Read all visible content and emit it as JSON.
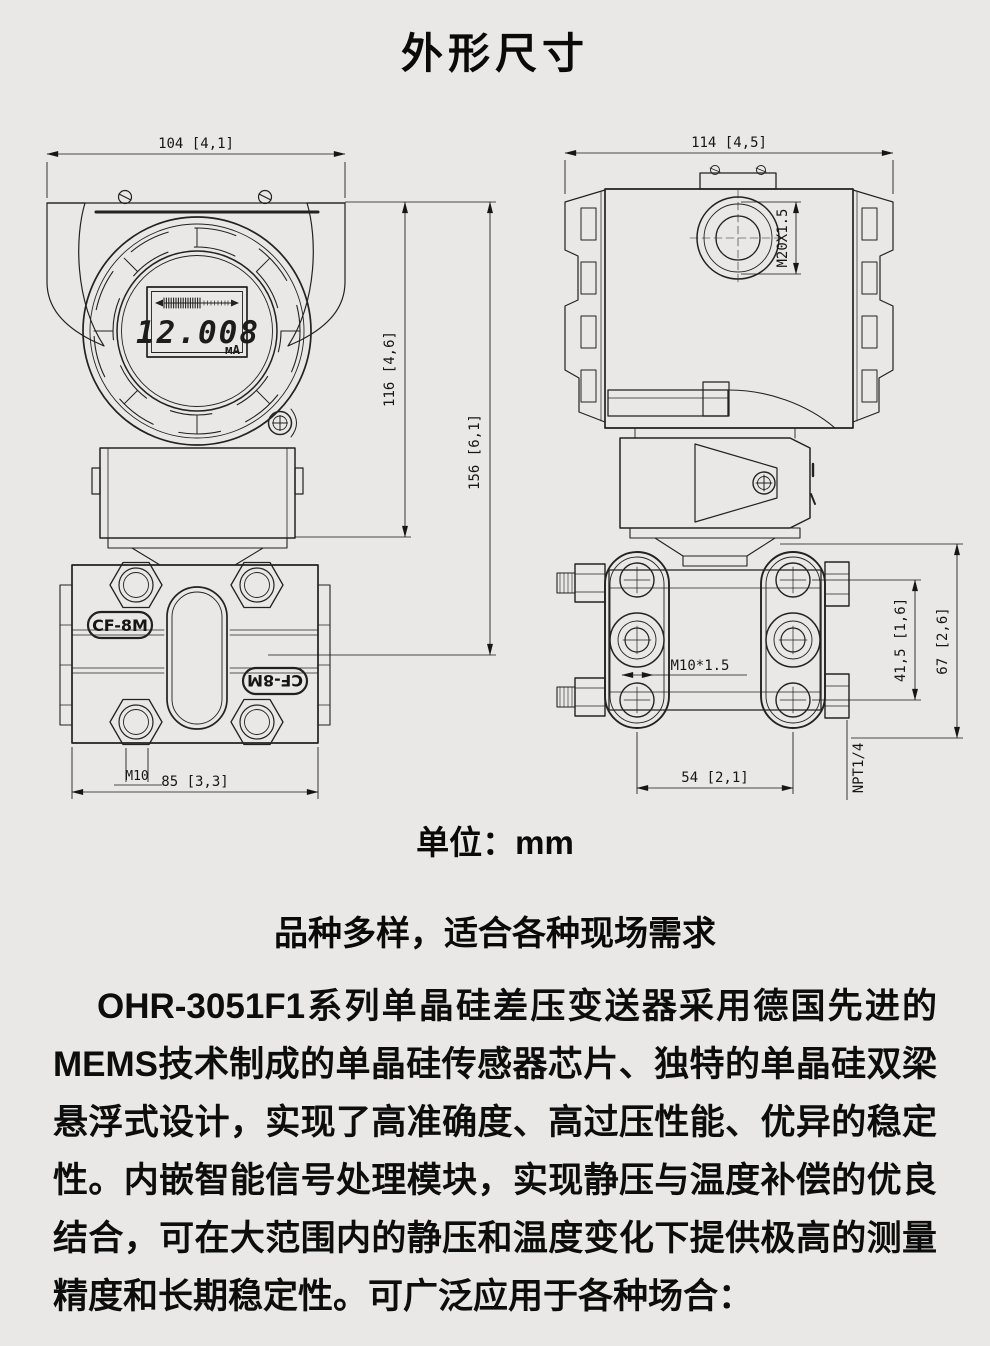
{
  "page": {
    "title": "外形尺寸",
    "unit_label": "单位：mm",
    "background_color": "#e9e8e6",
    "line_color": "#222222",
    "text_color": "#0a0a0a"
  },
  "front_view": {
    "dim_width_top": "104 [4,1]",
    "dim_height_body": "116 [4,6]",
    "dim_height_total": "156 [6,1]",
    "dim_flange_width": "85 [3,3]",
    "bolt_label": "M10",
    "lcd_value": "12.008",
    "lcd_unit": "мА",
    "flange_marking_left": "CF-8M",
    "flange_marking_right": "CF-8M"
  },
  "side_view": {
    "dim_width_top": "114 [4,5]",
    "gland_thread": "M20X1.5",
    "bolt_thread": "M10*1.5",
    "bolt_spacing_vertical": "41,5 [1,6]",
    "flange_height": "67 [2,6]",
    "bolt_spacing_horizontal": "54 [2,1]",
    "drain_valve_thread": "NPT1/4"
  },
  "section": {
    "heading": "品种多样，适合各种现场需求",
    "paragraph": "OHR-3051F1系列单晶硅差压变送器采用德国先进的MEMS技术制成的单晶硅传感器芯片、独特的单晶硅双梁悬浮式设计，实现了高准确度、高过压性能、优异的稳定性。内嵌智能信号处理模块，实现静压与温度补偿的优良结合，可在大范围内的静压和温度变化下提供极高的测量精度和长期稳定性。可广泛应用于各种场合："
  }
}
